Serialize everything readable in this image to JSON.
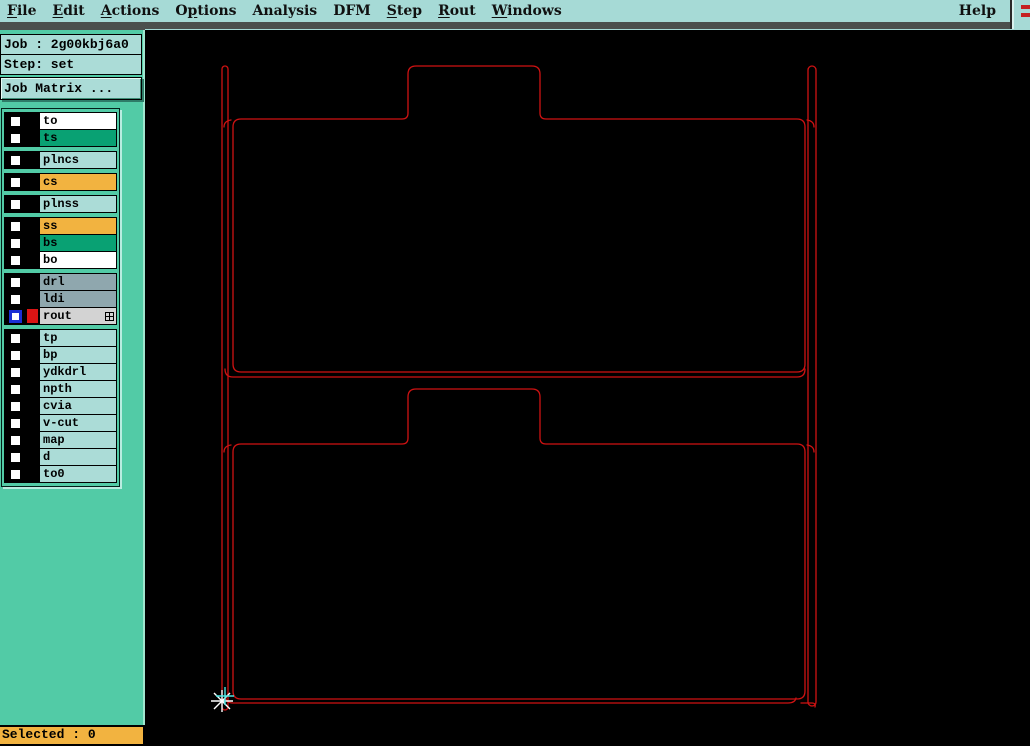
{
  "menubar": {
    "items": [
      {
        "label": "File",
        "underline": 0
      },
      {
        "label": "Edit",
        "underline": 0
      },
      {
        "label": "Actions",
        "underline": 0
      },
      {
        "label": "Options",
        "underline": 1
      },
      {
        "label": "Analysis",
        "underline": -1
      },
      {
        "label": "DFM",
        "underline": -1
      },
      {
        "label": "Step",
        "underline": 0
      },
      {
        "label": "Rout",
        "underline": 0
      },
      {
        "label": "Windows",
        "underline": 0
      }
    ],
    "help": {
      "label": "Help",
      "underline": -1
    }
  },
  "sidebar": {
    "job_label": "Job : 2g00kbj6a0",
    "step_label": "Step: set",
    "job_matrix_button": "Job Matrix ...",
    "layer_groups": [
      {
        "rows": [
          {
            "name": "to",
            "bg": "#ffffff"
          },
          {
            "name": "ts",
            "bg": "#09a173"
          }
        ]
      },
      {
        "rows": [
          {
            "name": "plncs",
            "bg": "#abdcd7"
          }
        ]
      },
      {
        "rows": [
          {
            "name": "cs",
            "bg": "#f2b340"
          }
        ]
      },
      {
        "rows": [
          {
            "name": "plnss",
            "bg": "#abdcd7"
          }
        ]
      },
      {
        "rows": [
          {
            "name": "ss",
            "bg": "#f2b340"
          },
          {
            "name": "bs",
            "bg": "#09a173"
          },
          {
            "name": "bo",
            "bg": "#ffffff"
          }
        ]
      },
      {
        "rows": [
          {
            "name": "drl",
            "bg": "#8fa7ae"
          },
          {
            "name": "ldi",
            "bg": "#8fa7ae"
          },
          {
            "name": "rout",
            "bg": "#d3d3d3",
            "active": true,
            "swatch": "#da1414",
            "icon": "grid"
          }
        ]
      },
      {
        "rows": [
          {
            "name": "tp",
            "bg": "#abdcd7"
          },
          {
            "name": "bp",
            "bg": "#abdcd7"
          },
          {
            "name": "ydkdrl",
            "bg": "#abdcd7"
          },
          {
            "name": "npth",
            "bg": "#abdcd7"
          },
          {
            "name": "cvia",
            "bg": "#abdcd7"
          },
          {
            "name": "v-cut",
            "bg": "#abdcd7"
          },
          {
            "name": "map",
            "bg": "#abdcd7"
          },
          {
            "name": "d",
            "bg": "#abdcd7"
          },
          {
            "name": "to0",
            "bg": "#abdcd7"
          }
        ]
      }
    ]
  },
  "statusbar": {
    "selected_label": "Selected : 0"
  },
  "canvas": {
    "path_color": "#cf1212",
    "origin_marker": {
      "star_color": "#ffffff",
      "cross_color": "#49e6e2"
    }
  },
  "peek_window": {
    "dash_color": "#c52222",
    "dash_count": 2
  }
}
